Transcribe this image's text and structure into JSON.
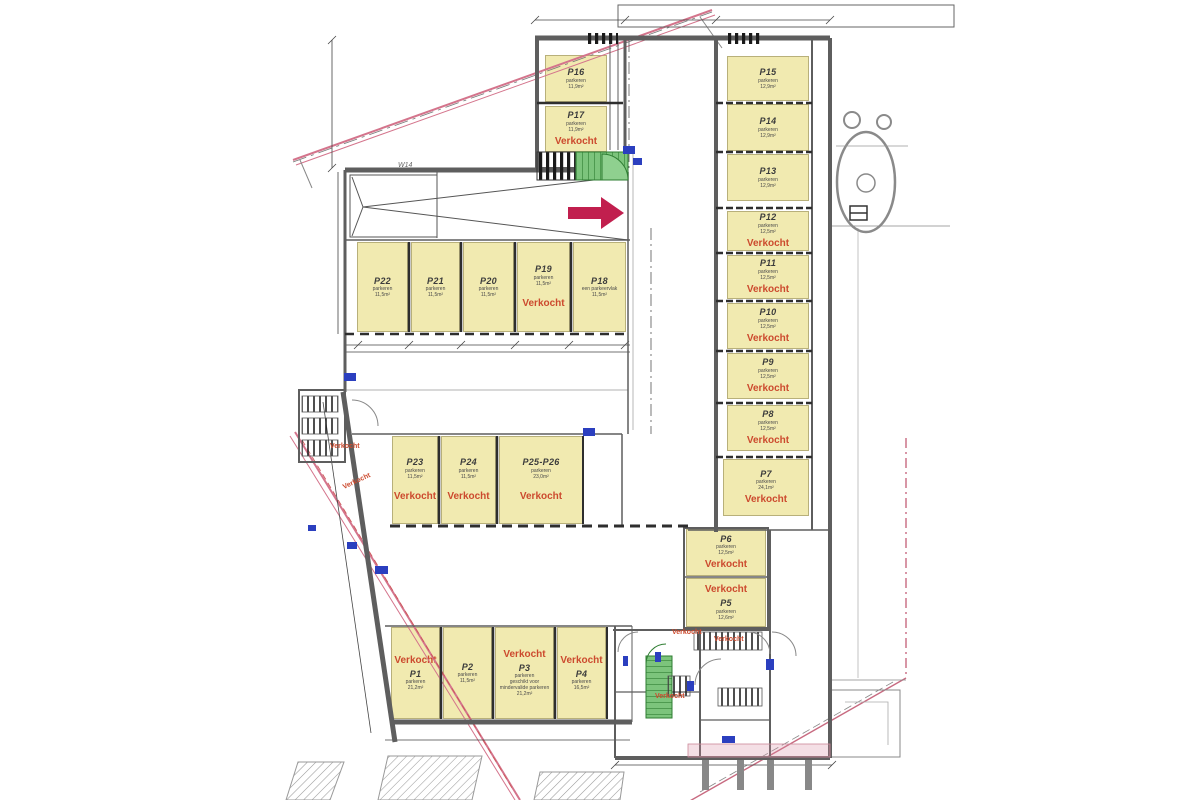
{
  "plan": {
    "type": "parking-garage-floor-plan",
    "sold_label": "Verkocht",
    "colors": {
      "space_fill": "#f1eab0",
      "sold_text": "#cc4a2e",
      "label_text": "#3c3c3c",
      "boundary_pink": "#d4748c",
      "stair_green": "#7cc47c",
      "arrow_red": "#c11f4e",
      "symbol_blue": "#2b3fbf",
      "wall_gray": "#5e5e5e"
    },
    "spaces": [
      {
        "id": "P16",
        "label": "P16",
        "sub": "parkeren",
        "area": "11,9m²",
        "sold": false,
        "sold_pos": "below",
        "x": 545,
        "y": 55,
        "w": 62,
        "h": 47
      },
      {
        "id": "P17",
        "label": "P17",
        "sub": "parkeren",
        "area": "11,9m²",
        "sold": true,
        "sold_pos": "below",
        "x": 545,
        "y": 106,
        "w": 62,
        "h": 46
      },
      {
        "id": "P15",
        "label": "P15",
        "sub": "parkeren",
        "area": "12,9m²",
        "sold": false,
        "sold_pos": "below",
        "x": 727,
        "y": 56,
        "w": 82,
        "h": 45
      },
      {
        "id": "P14",
        "label": "P14",
        "sub": "parkeren",
        "area": "12,9m²",
        "sold": false,
        "sold_pos": "below",
        "x": 727,
        "y": 104,
        "w": 82,
        "h": 47
      },
      {
        "id": "P13",
        "label": "P13",
        "sub": "parkeren",
        "area": "12,9m²",
        "sold": false,
        "sold_pos": "below",
        "x": 727,
        "y": 154,
        "w": 82,
        "h": 47
      },
      {
        "id": "P12",
        "label": "P12",
        "sub": "parkeren",
        "area": "12,5m²",
        "sold": true,
        "sold_pos": "below",
        "x": 727,
        "y": 211,
        "w": 82,
        "h": 40
      },
      {
        "id": "P11",
        "label": "P11",
        "sub": "parkeren",
        "area": "12,5m²",
        "sold": true,
        "sold_pos": "below",
        "x": 727,
        "y": 255,
        "w": 82,
        "h": 44
      },
      {
        "id": "P10",
        "label": "P10",
        "sub": "parkeren",
        "area": "12,5m²",
        "sold": true,
        "sold_pos": "below",
        "x": 727,
        "y": 303,
        "w": 82,
        "h": 46
      },
      {
        "id": "P9",
        "label": "P9",
        "sub": "parkeren",
        "area": "12,5m²",
        "sold": true,
        "sold_pos": "below",
        "x": 727,
        "y": 353,
        "w": 82,
        "h": 46
      },
      {
        "id": "P8",
        "label": "P8",
        "sub": "parkeren",
        "area": "12,5m²",
        "sold": true,
        "sold_pos": "below",
        "x": 727,
        "y": 405,
        "w": 82,
        "h": 46
      },
      {
        "id": "P7",
        "label": "P7",
        "sub": "parkeren",
        "area": "24,1m²",
        "sold": true,
        "sold_pos": "below",
        "x": 723,
        "y": 459,
        "w": 86,
        "h": 57
      },
      {
        "id": "P22",
        "label": "P22",
        "sub": "parkeren",
        "area": "11,5m²",
        "sold": false,
        "sold_pos": "below",
        "x": 357,
        "y": 242,
        "w": 51,
        "h": 90
      },
      {
        "id": "P21",
        "label": "P21",
        "sub": "parkeren",
        "area": "11,5m²",
        "sold": false,
        "sold_pos": "below",
        "x": 411,
        "y": 242,
        "w": 49,
        "h": 90
      },
      {
        "id": "P20",
        "label": "P20",
        "sub": "parkeren",
        "area": "11,5m²",
        "sold": false,
        "sold_pos": "below",
        "x": 463,
        "y": 242,
        "w": 51,
        "h": 90
      },
      {
        "id": "P19",
        "label": "P19",
        "sub": "parkeren",
        "area": "11,5m²",
        "sold": true,
        "sold_pos": "below",
        "x": 517,
        "y": 242,
        "w": 53,
        "h": 90
      },
      {
        "id": "P18",
        "label": "P18",
        "sub": "een parkeervlak",
        "area": "11,5m²",
        "sold": false,
        "sold_pos": "below",
        "x": 573,
        "y": 242,
        "w": 53,
        "h": 90
      },
      {
        "id": "P23",
        "label": "P23",
        "sub": "parkeren",
        "area": "11,5m²",
        "sold": true,
        "sold_pos": "below",
        "x": 392,
        "y": 436,
        "w": 46,
        "h": 88
      },
      {
        "id": "P24",
        "label": "P24",
        "sub": "parkeren",
        "area": "11,5m²",
        "sold": true,
        "sold_pos": "below",
        "x": 441,
        "y": 436,
        "w": 55,
        "h": 88
      },
      {
        "id": "P25-P26",
        "label": "P25-P26",
        "sub": "parkeren",
        "area": "23,0m²",
        "sold": true,
        "sold_pos": "below",
        "x": 499,
        "y": 436,
        "w": 84,
        "h": 88
      },
      {
        "id": "P1",
        "label": "P1",
        "sub": "parkeren",
        "area": "21,2m²",
        "sold": true,
        "sold_pos": "above",
        "x": 391,
        "y": 627,
        "w": 49,
        "h": 92
      },
      {
        "id": "P2",
        "label": "P2",
        "sub": "parkeren",
        "area": "11,5m²",
        "sold": false,
        "sold_pos": "below",
        "x": 443,
        "y": 627,
        "w": 49,
        "h": 92
      },
      {
        "id": "P3",
        "label": "P3",
        "sub": "parkeren",
        "sub2": "geschikt voor mindervalide parkeren",
        "area": "21,2m²",
        "sold": true,
        "sold_pos": "above",
        "x": 495,
        "y": 627,
        "w": 59,
        "h": 92
      },
      {
        "id": "P4",
        "label": "P4",
        "sub": "parkeren",
        "area": "16,5m²",
        "sold": true,
        "sold_pos": "above",
        "x": 557,
        "y": 627,
        "w": 49,
        "h": 92
      },
      {
        "id": "P6",
        "label": "P6",
        "sub": "parkeren",
        "area": "12,5m²",
        "sold": true,
        "sold_pos": "below",
        "x": 686,
        "y": 529,
        "w": 80,
        "h": 47
      },
      {
        "id": "P5",
        "label": "P5",
        "sub": "parkeren",
        "area": "12,6m²",
        "sold": true,
        "sold_pos": "above",
        "x": 686,
        "y": 578,
        "w": 80,
        "h": 49
      }
    ],
    "sold_marks": [
      {
        "x": 330,
        "y": 443,
        "rot": 0
      },
      {
        "x": 342,
        "y": 478,
        "rot": -25
      },
      {
        "x": 672,
        "y": 629,
        "rot": 0
      },
      {
        "x": 714,
        "y": 636,
        "rot": 0
      },
      {
        "x": 655,
        "y": 693,
        "rot": 0
      }
    ],
    "annotations": [
      {
        "text": "W14",
        "x": 398,
        "y": 162
      }
    ]
  }
}
